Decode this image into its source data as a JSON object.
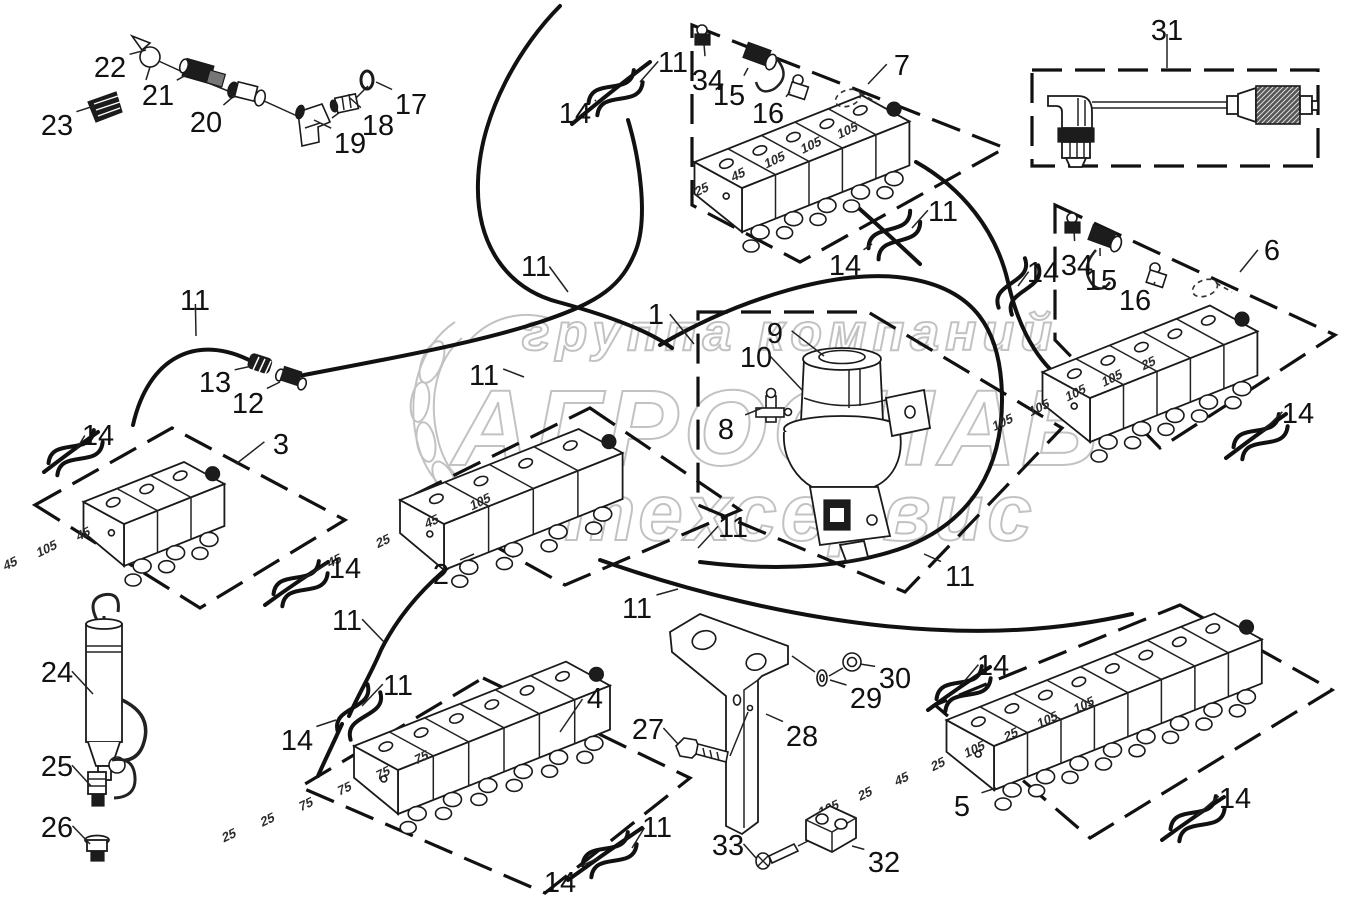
{
  "watermark": {
    "top": "группа компаний",
    "middle": "АГРОСНАБ",
    "bottom": "техсервис"
  },
  "blocks": {
    "7": {
      "sections": [
        "105",
        "105",
        "105",
        "45",
        "25"
      ]
    },
    "6": {
      "sections": [
        "25",
        "105",
        "105",
        "105",
        "105"
      ]
    },
    "3": {
      "sections": [
        "45",
        "105",
        "45"
      ]
    },
    "2": {
      "sections": [
        "105",
        "45",
        "25",
        "45"
      ]
    },
    "4": {
      "sections": [
        "75",
        "75",
        "75",
        "75",
        "25",
        "25"
      ]
    },
    "5": {
      "sections": [
        "105",
        "105",
        "25",
        "105",
        "25",
        "45",
        "25",
        "105"
      ]
    }
  },
  "callouts": [
    {
      "label": "22",
      "x": 110,
      "y": 67,
      "tx": 146,
      "ty": 50
    },
    {
      "label": "21",
      "x": 158,
      "y": 95,
      "tx": 188,
      "ty": 74
    },
    {
      "label": "23",
      "x": 57,
      "y": 125,
      "tx": 94,
      "ty": 106
    },
    {
      "label": "20",
      "x": 206,
      "y": 122,
      "tx": 234,
      "ty": 96
    },
    {
      "label": "19",
      "x": 350,
      "y": 143,
      "tx": 314,
      "ty": 120
    },
    {
      "label": "18",
      "x": 378,
      "y": 125,
      "tx": 350,
      "ty": 98
    },
    {
      "label": "17",
      "x": 411,
      "y": 104,
      "tx": 376,
      "ty": 82
    },
    {
      "label": "14",
      "x": 575,
      "y": 113,
      "tx": 596,
      "ty": 100
    },
    {
      "label": "11",
      "x": 673,
      "y": 62,
      "tx": 640,
      "ty": 82
    },
    {
      "label": "34",
      "x": 708,
      "y": 80,
      "tx": 704,
      "ty": 44
    },
    {
      "label": "15",
      "x": 729,
      "y": 95,
      "tx": 748,
      "ty": 68
    },
    {
      "label": "16",
      "x": 768,
      "y": 113,
      "tx": 790,
      "ty": 92
    },
    {
      "label": "7",
      "x": 902,
      "y": 65,
      "tx": 868,
      "ty": 84
    },
    {
      "label": "14",
      "x": 845,
      "y": 265,
      "tx": 872,
      "ty": 244
    },
    {
      "label": "11",
      "x": 943,
      "y": 211,
      "tx": 912,
      "ty": 228
    },
    {
      "label": "31",
      "x": 1167,
      "y": 30,
      "tx": 1167,
      "ty": 68
    },
    {
      "label": "34",
      "x": 1077,
      "y": 265,
      "tx": 1074,
      "ty": 230
    },
    {
      "label": "15",
      "x": 1101,
      "y": 280,
      "tx": 1100,
      "ty": 248
    },
    {
      "label": "16",
      "x": 1135,
      "y": 300,
      "tx": 1155,
      "ty": 282
    },
    {
      "label": "6",
      "x": 1272,
      "y": 250,
      "tx": 1240,
      "ty": 272
    },
    {
      "label": "14",
      "x": 1043,
      "y": 272,
      "tx": 1018,
      "ty": 286
    },
    {
      "label": "14",
      "x": 1298,
      "y": 413,
      "tx": 1262,
      "ty": 432
    },
    {
      "label": "11",
      "x": 536,
      "y": 266,
      "tx": 568,
      "ty": 292
    },
    {
      "label": "1",
      "x": 656,
      "y": 314,
      "tx": 694,
      "ty": 344
    },
    {
      "label": "9",
      "x": 775,
      "y": 333,
      "tx": 824,
      "ty": 356
    },
    {
      "label": "10",
      "x": 756,
      "y": 357,
      "tx": 802,
      "ty": 390
    },
    {
      "label": "8",
      "x": 726,
      "y": 429,
      "tx": 762,
      "ty": 408
    },
    {
      "label": "11",
      "x": 484,
      "y": 375,
      "tx": 524,
      "ty": 377
    },
    {
      "label": "13",
      "x": 215,
      "y": 382,
      "tx": 252,
      "ty": 366
    },
    {
      "label": "12",
      "x": 248,
      "y": 403,
      "tx": 280,
      "ty": 382
    },
    {
      "label": "11",
      "x": 195,
      "y": 300,
      "tx": 196,
      "ty": 336
    },
    {
      "label": "14",
      "x": 98,
      "y": 435,
      "tx": 76,
      "ty": 450
    },
    {
      "label": "3",
      "x": 281,
      "y": 444,
      "tx": 236,
      "ty": 464
    },
    {
      "label": "14",
      "x": 345,
      "y": 568,
      "tx": 300,
      "ty": 580
    },
    {
      "label": "2",
      "x": 441,
      "y": 574,
      "tx": 474,
      "ty": 554
    },
    {
      "label": "11",
      "x": 347,
      "y": 620,
      "tx": 384,
      "ty": 642
    },
    {
      "label": "11",
      "x": 398,
      "y": 685,
      "tx": 362,
      "ty": 706
    },
    {
      "label": "14",
      "x": 297,
      "y": 740,
      "tx": 336,
      "ty": 720
    },
    {
      "label": "4",
      "x": 595,
      "y": 698,
      "tx": 560,
      "ty": 732
    },
    {
      "label": "11",
      "x": 637,
      "y": 608,
      "tx": 678,
      "ty": 589
    },
    {
      "label": "11",
      "x": 733,
      "y": 527,
      "tx": 698,
      "ty": 548
    },
    {
      "label": "11",
      "x": 960,
      "y": 576,
      "tx": 924,
      "ty": 554
    },
    {
      "label": "14",
      "x": 993,
      "y": 665,
      "tx": 962,
      "ty": 684
    },
    {
      "label": "27",
      "x": 648,
      "y": 729,
      "tx": 678,
      "ty": 744
    },
    {
      "label": "28",
      "x": 802,
      "y": 736,
      "tx": 766,
      "ty": 714
    },
    {
      "label": "29",
      "x": 866,
      "y": 698,
      "tx": 830,
      "ty": 680
    },
    {
      "label": "30",
      "x": 895,
      "y": 678,
      "tx": 860,
      "ty": 664
    },
    {
      "label": "33",
      "x": 728,
      "y": 845,
      "tx": 756,
      "ty": 858
    },
    {
      "label": "32",
      "x": 884,
      "y": 862,
      "tx": 852,
      "ty": 846
    },
    {
      "label": "5",
      "x": 962,
      "y": 806,
      "tx": 996,
      "ty": 788
    },
    {
      "label": "14",
      "x": 1235,
      "y": 798,
      "tx": 1196,
      "ty": 816
    },
    {
      "label": "11",
      "x": 657,
      "y": 827,
      "tx": 632,
      "ty": 848
    },
    {
      "label": "14",
      "x": 560,
      "y": 882,
      "tx": 598,
      "ty": 858
    },
    {
      "label": "24",
      "x": 57,
      "y": 672,
      "tx": 93,
      "ty": 694
    },
    {
      "label": "25",
      "x": 57,
      "y": 766,
      "tx": 91,
      "ty": 786
    },
    {
      "label": "26",
      "x": 57,
      "y": 827,
      "tx": 90,
      "ty": 844
    }
  ]
}
